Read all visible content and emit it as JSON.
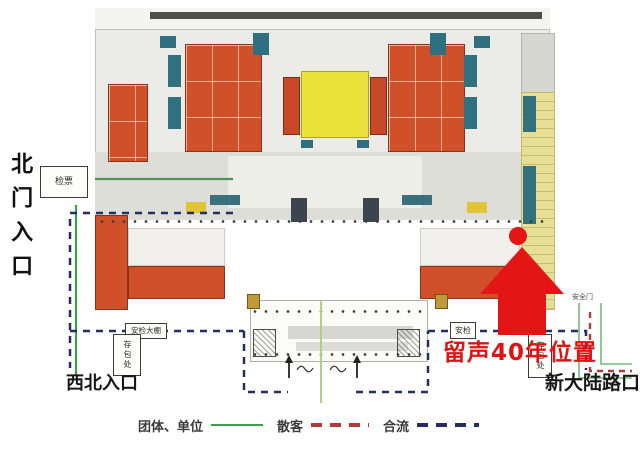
{
  "entrances": {
    "north": "北门入口",
    "northwest": "西北入口",
    "road_corner": "新大陆路口"
  },
  "highlight": {
    "text": "留声40年位置",
    "color": "#e31212",
    "marker": "red-arrow-with-dot"
  },
  "facilities": {
    "ticket_check": "检票",
    "security_shed": "安检大棚",
    "security_east": "安检",
    "bag_storage_west": "存包处",
    "bag_storage_east": "存包处",
    "safety_gate": "安全门"
  },
  "legend": {
    "items": [
      {
        "label": "团体、单位",
        "line": "solid",
        "color": "#3fa04a"
      },
      {
        "label": "散客",
        "line": "dashed",
        "color": "#b23a3a"
      },
      {
        "label": "合流",
        "line": "dashed",
        "color": "#232f63"
      }
    ]
  },
  "colors": {
    "arrow_red": "#e31515",
    "hall_orange": "#d0502a",
    "central_hall_yellow": "#ebe33c",
    "room_teal": "#2f6f80",
    "east_corridor_yellow": "#e6df96",
    "plan_gray": "#ebebe7"
  }
}
